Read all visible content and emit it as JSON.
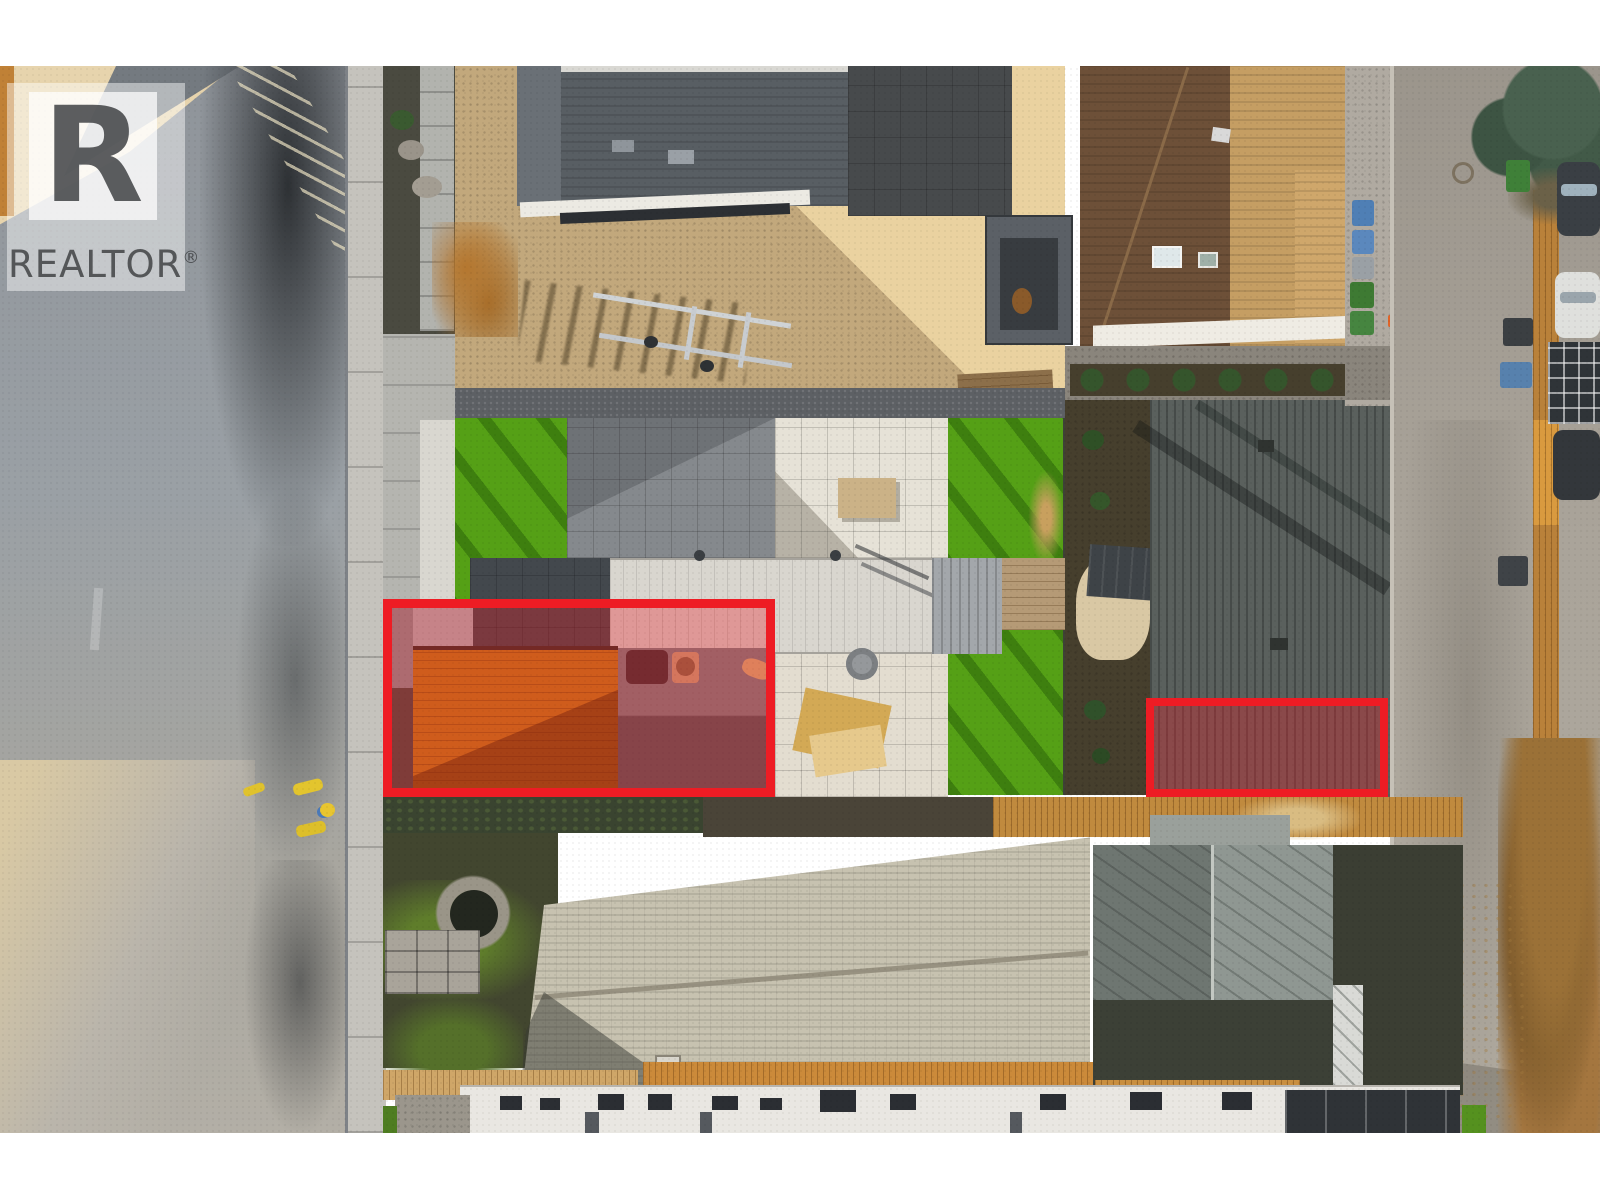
{
  "watermark": {
    "brand": "REALTOR",
    "registered": "®",
    "logo_letter": "R"
  },
  "annotations": {
    "highlights": [
      {
        "id": "highlight-front-deck-patio",
        "x": 383,
        "y": 599,
        "w": 392,
        "h": 198,
        "stroke": "#ee1c24",
        "stroke_width": 9,
        "fill": "rgba(238,28,36,0.33)"
      },
      {
        "id": "highlight-neighbor-roof-section",
        "x": 1146,
        "y": 698,
        "w": 242,
        "h": 99,
        "stroke": "#ee1c24",
        "stroke_width": 8,
        "fill": "rgba(238,28,36,0.33)"
      }
    ]
  },
  "palette": {
    "highlight-red": "#ee1c24",
    "highlight-fill": "rgba(238,28,36,0.33)",
    "watermark-ink": "rgba(64,66,68,0.85)",
    "turf-green": "#55a016",
    "sand": "#c2a87c",
    "sand-sun": "#ead2a0",
    "street-left": "#979da2",
    "street-right": "#a59f95",
    "slate-roof": "#5a605d",
    "brown-roof": "#6d5038",
    "brown-roof-sun": "#c59e63",
    "pale-roof": "#c7c2b0",
    "white-paver": "#e6e2d7",
    "wood-deck": "#c07d18",
    "wood-fence": "#b9813a"
  },
  "photo": {
    "letterbox_color": "#ffffff",
    "top_bar_height": 66,
    "bottom_bar_height": 67
  }
}
